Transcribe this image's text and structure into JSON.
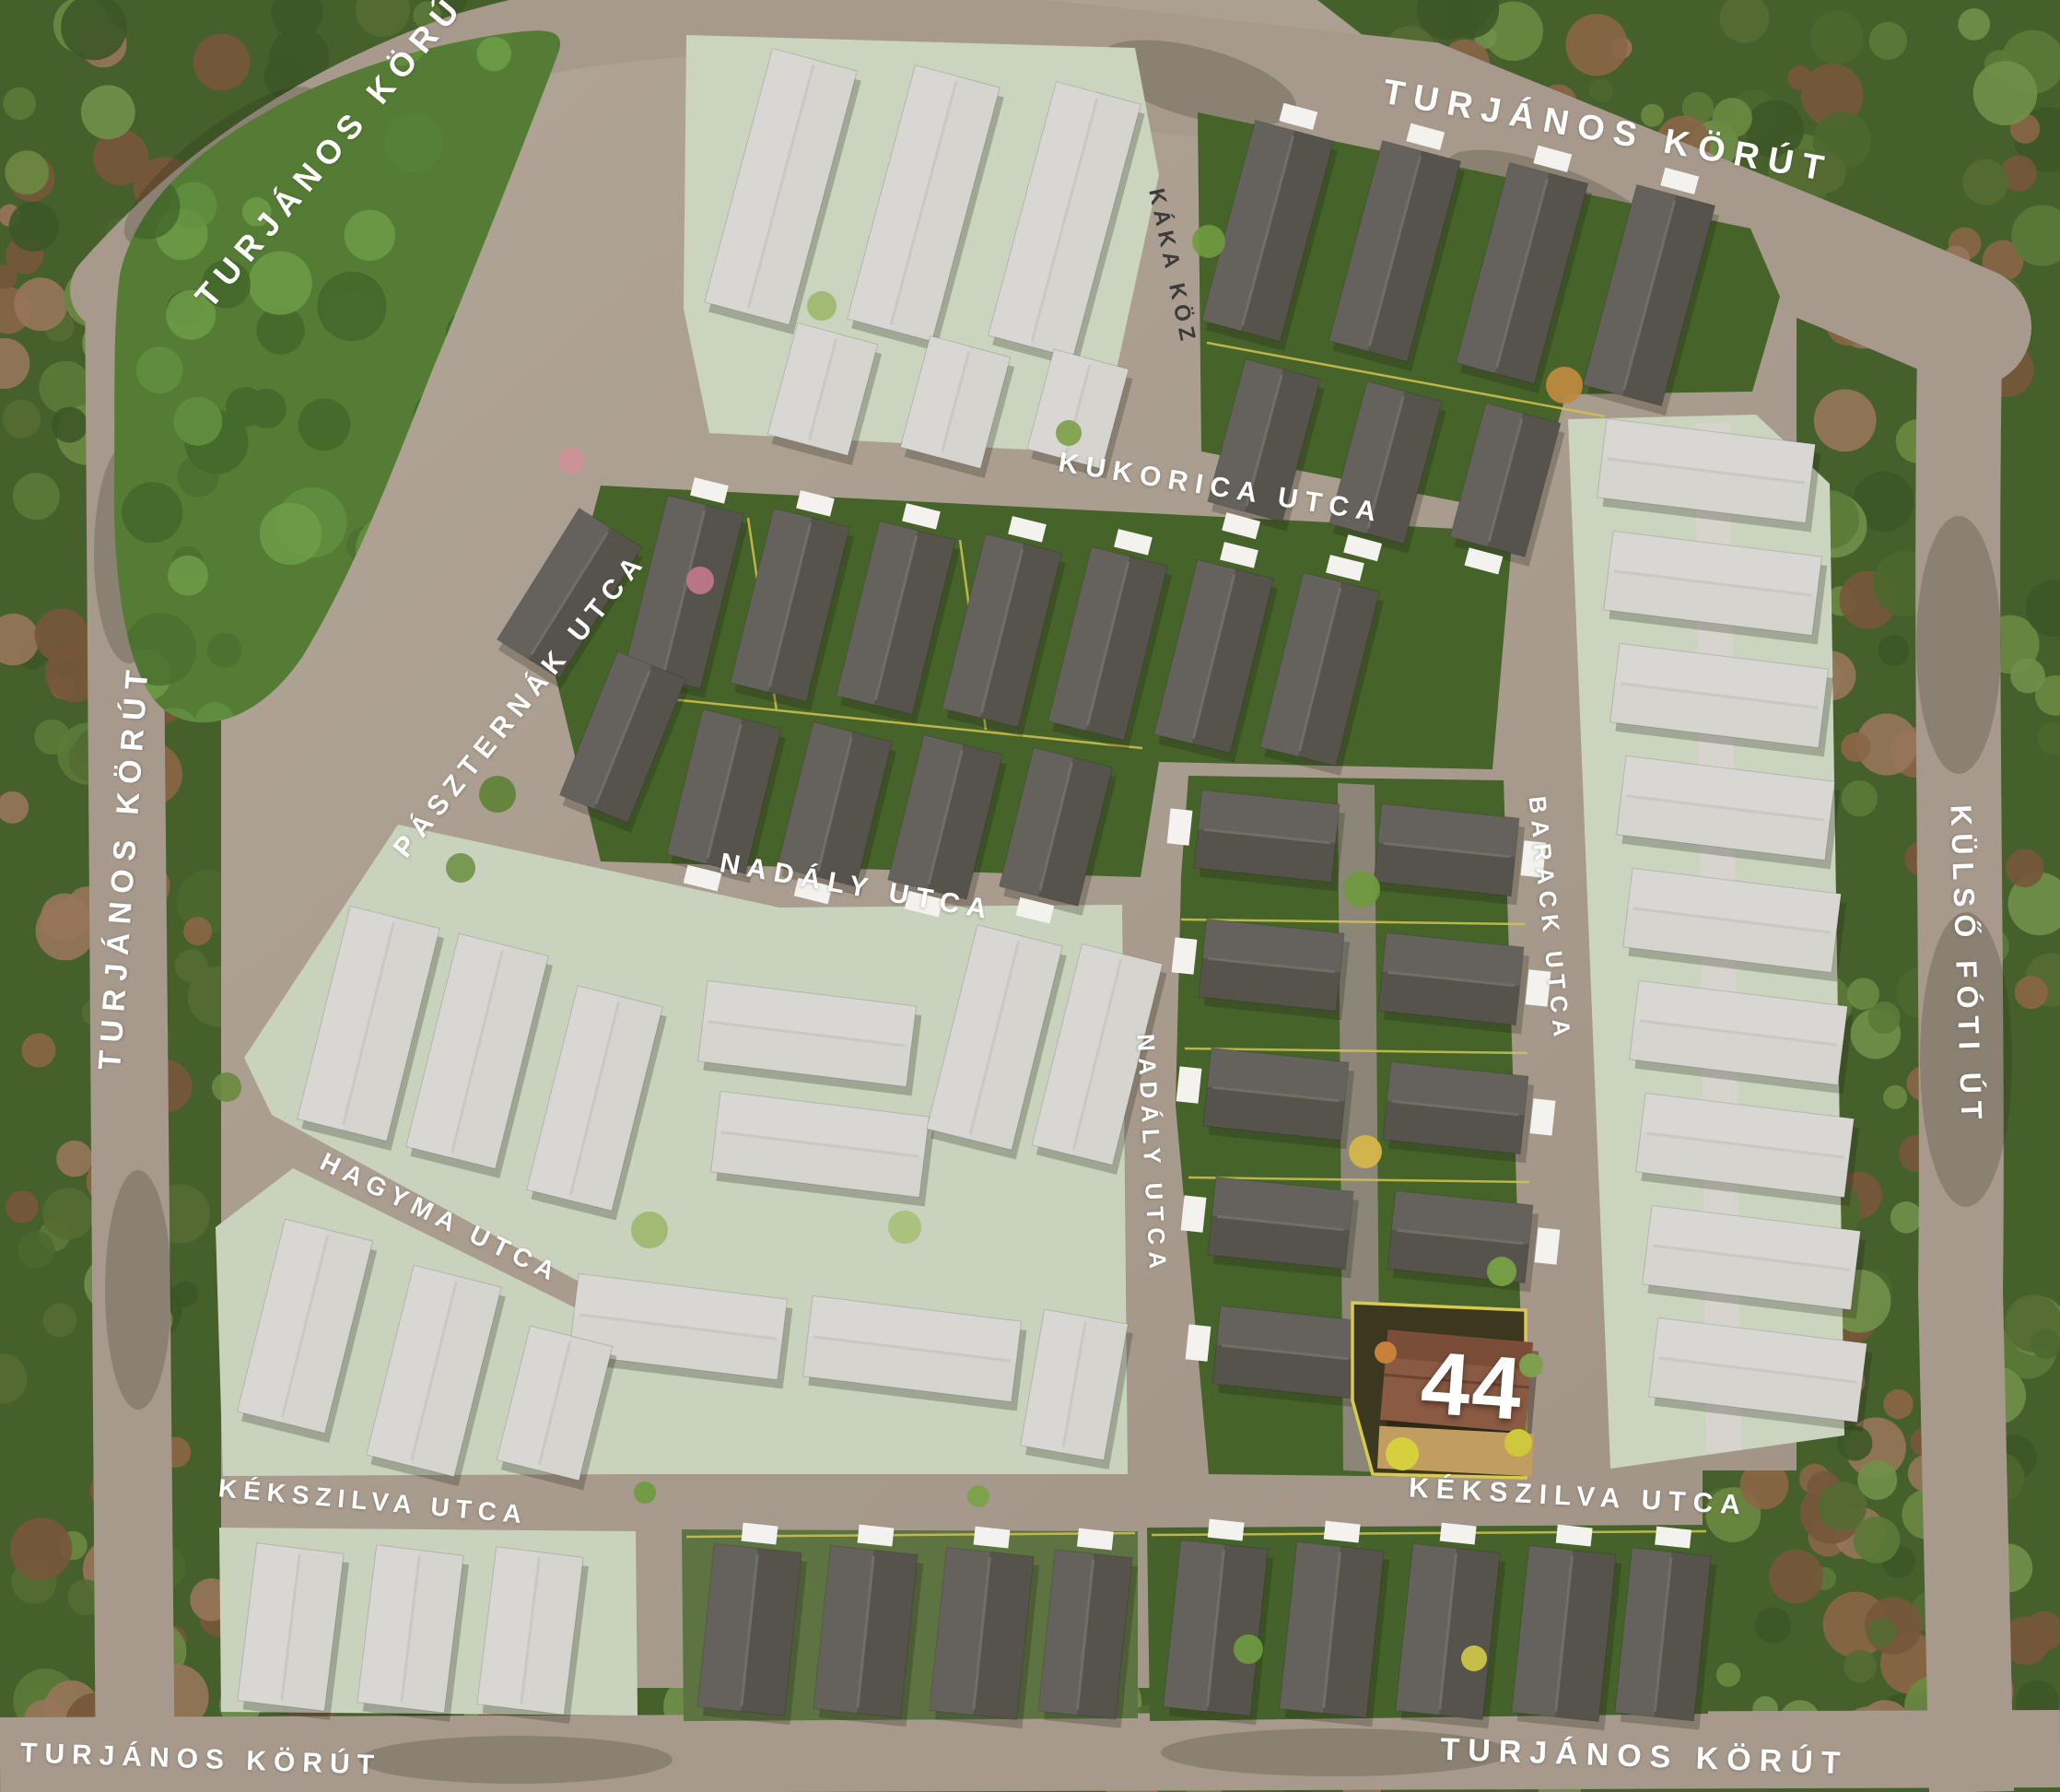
{
  "street_labels": [
    {
      "id": "turjanos-korut-top-left",
      "name": "TURJÁNOS KÖRÚT"
    },
    {
      "id": "turjanos-korut-top-right",
      "name": "TURJÁNOS KÖRÚT"
    },
    {
      "id": "turjanos-korut-left",
      "name": "TURJÁNOS KÖRÚT"
    },
    {
      "id": "kulso-foti-ut",
      "name": "KÜLSŐ FÓTI ÚT"
    },
    {
      "id": "kaka-koz",
      "name": "KÁKA KÖZ"
    },
    {
      "id": "kukorica-utca",
      "name": "KUKORICA UTCA"
    },
    {
      "id": "paszternak-utca",
      "name": "PÁSZTERNÁK UTCA"
    },
    {
      "id": "nadaly-utca-horizontal",
      "name": "NADÁLY UTCA"
    },
    {
      "id": "nadaly-utca-vertical",
      "name": "NADÁLY UTCA"
    },
    {
      "id": "barack-utca",
      "name": "BARACK UTCA"
    },
    {
      "id": "hagyma-utca",
      "name": "HAGYMA UTCA"
    },
    {
      "id": "kekszilva-utca-left",
      "name": "KÉKSZILVA UTCA"
    },
    {
      "id": "kekszilva-utca-right",
      "name": "KÉKSZILVA UTCA"
    },
    {
      "id": "turjanos-korut-bottom-left",
      "name": "TURJÁNOS KÖRÚT"
    },
    {
      "id": "turjanos-korut-bottom-right",
      "name": "TURJÁNOS KÖRÚT"
    }
  ],
  "highlighted_plot": {
    "number": "44"
  },
  "colors": {
    "road": "#a79a8d",
    "forest": "#46602c",
    "available_block": "#46632a",
    "sold_block": "#cbd4bf",
    "available_house": "#56534d",
    "sold_house": "#d5d4cf",
    "highlight_roof": "#8a5a43",
    "highlight_ground": "#3c381f",
    "plot_outline": "#d9c94f",
    "label_text": "#ffffff"
  }
}
